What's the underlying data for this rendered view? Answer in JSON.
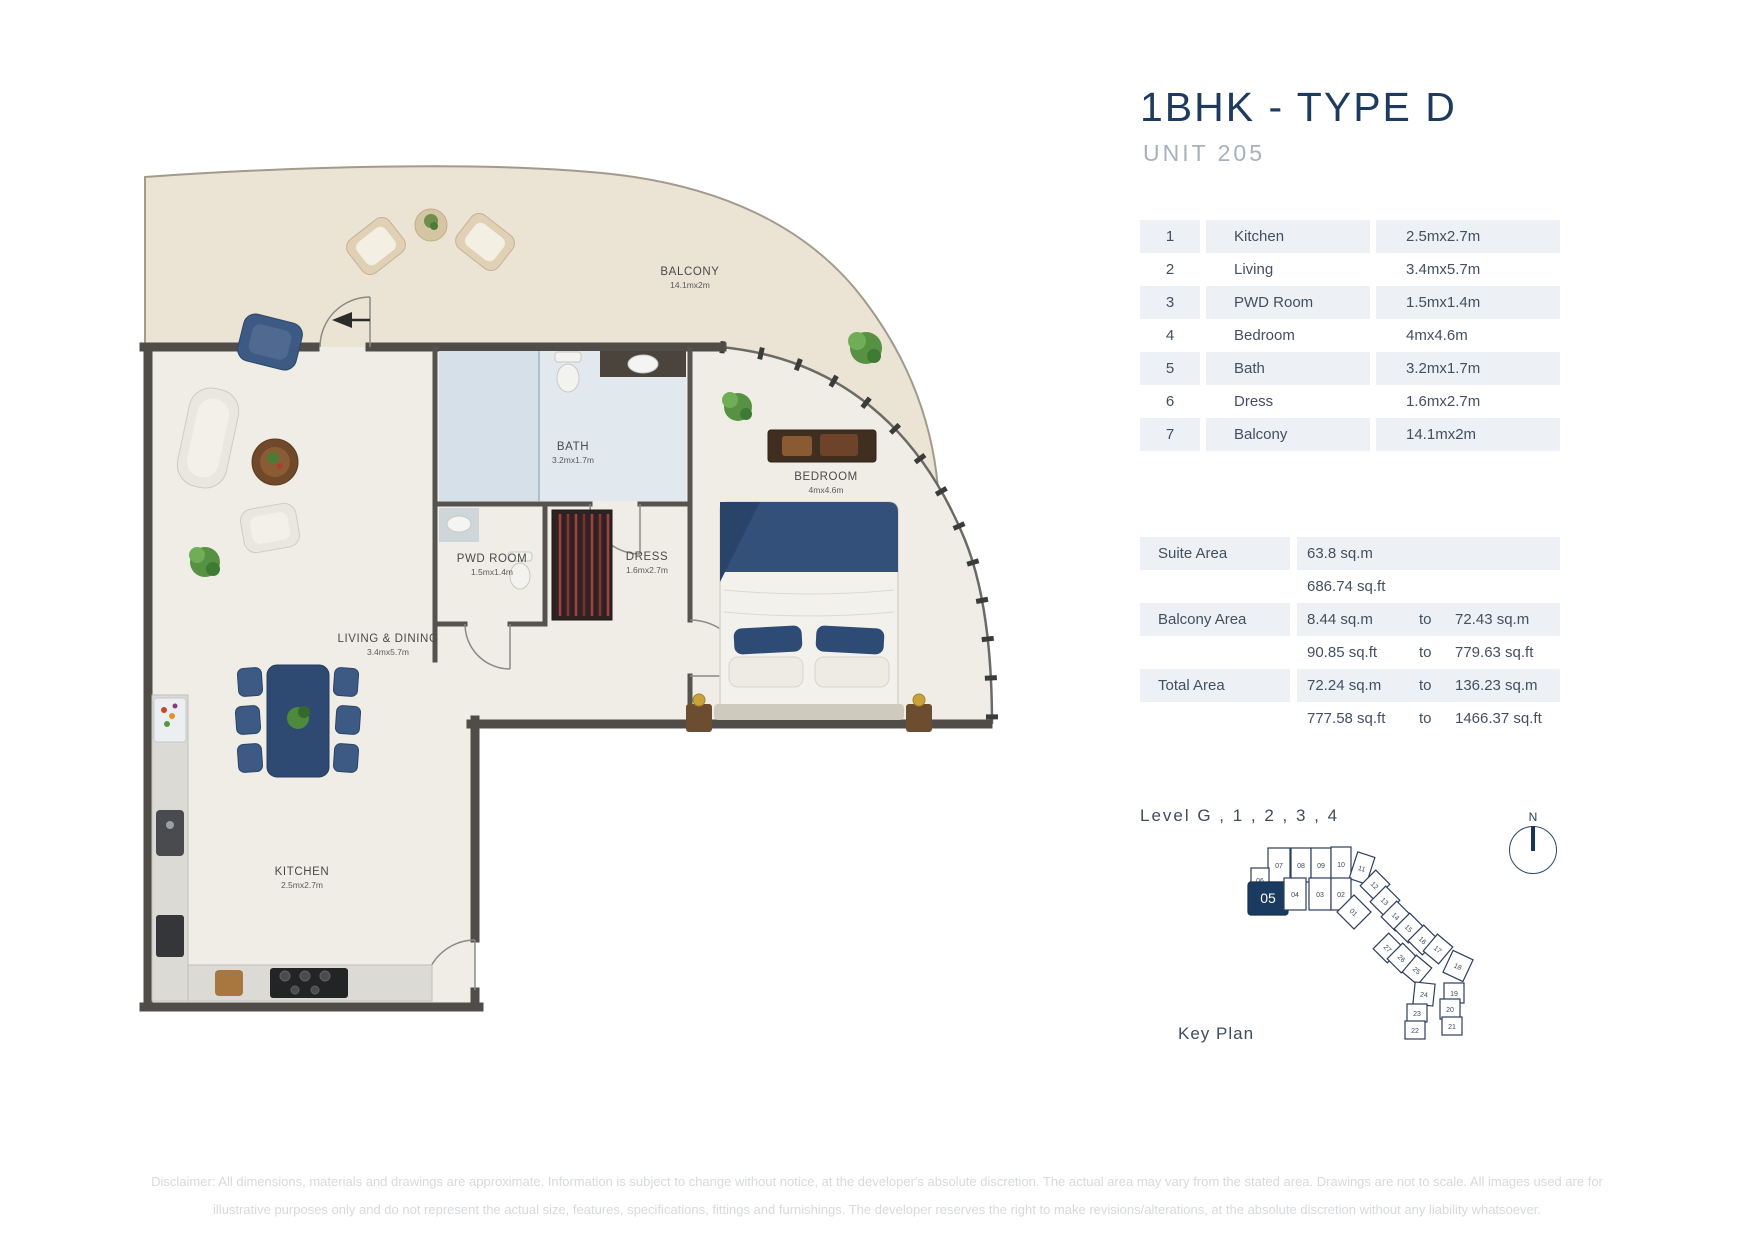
{
  "header": {
    "title": "1BHK - TYPE D",
    "subtitle": "UNIT 205"
  },
  "dimension_table": {
    "rows": [
      {
        "num": "1",
        "name": "Kitchen",
        "size": "2.5mx2.7m"
      },
      {
        "num": "2",
        "name": "Living",
        "size": "3.4mx5.7m"
      },
      {
        "num": "3",
        "name": "PWD Room",
        "size": "1.5mx1.4m"
      },
      {
        "num": "4",
        "name": "Bedroom",
        "size": "4mx4.6m"
      },
      {
        "num": "5",
        "name": "Bath",
        "size": "3.2mx1.7m"
      },
      {
        "num": "6",
        "name": "Dress",
        "size": "1.6mx2.7m"
      },
      {
        "num": "7",
        "name": "Balcony",
        "size": "14.1mx2m"
      }
    ]
  },
  "area_table": {
    "rows": [
      {
        "label": "Suite Area",
        "v1": "63.8 sq.m",
        "to": "",
        "v2": ""
      },
      {
        "label": "",
        "v1": "686.74 sq.ft",
        "to": "",
        "v2": ""
      },
      {
        "label": "Balcony Area",
        "v1": "8.44 sq.m",
        "to": "to",
        "v2": "72.43 sq.m"
      },
      {
        "label": "",
        "v1": "90.85 sq.ft",
        "to": "to",
        "v2": "779.63 sq.ft"
      },
      {
        "label": "Total Area",
        "v1": "72.24 sq.m",
        "to": "to",
        "v2": "136.23 sq.m"
      },
      {
        "label": "",
        "v1": "777.58 sq.ft",
        "to": "to",
        "v2": "1466.37 sq.ft"
      }
    ]
  },
  "level": {
    "label": "Level  G , 1 , 2 , 3 , 4"
  },
  "key_plan": {
    "label": "Key Plan",
    "highlighted_unit": "05",
    "units": [
      "01",
      "02",
      "03",
      "04",
      "05",
      "06",
      "07",
      "08",
      "09",
      "10",
      "11",
      "12",
      "13",
      "14",
      "15",
      "16",
      "17",
      "18",
      "19",
      "20",
      "21",
      "22",
      "23",
      "24",
      "25",
      "26",
      "27"
    ]
  },
  "compass": {
    "north_label": "N"
  },
  "floorplan": {
    "rooms": [
      {
        "name": "BALCONY",
        "dims": "14.1mx2m"
      },
      {
        "name": "BATH",
        "dims": "3.2mx1.7m"
      },
      {
        "name": "BEDROOM",
        "dims": "4mx4.6m"
      },
      {
        "name": "PWD ROOM",
        "dims": "1.5mx1.4m"
      },
      {
        "name": "DRESS",
        "dims": "1.6mx2.7m"
      },
      {
        "name": "LIVING & DINING",
        "dims": "3.4mx5.7m"
      },
      {
        "name": "KITCHEN",
        "dims": "2.5mx2.7m"
      }
    ]
  },
  "disclaimer": {
    "line1": "Disclaimer: All dimensions, materials and drawings are approximate. Information is subject to change without notice, at the developer's absolute discretion. The actual area may vary from the stated area. Drawings are not to scale. All images used are for",
    "line2": "illustrative purposes only and do not represent the actual size, features, specifications, fittings and furnishings. The developer reserves the right to make revisions/alterations, at the absolute discretion without any liability whatsoever."
  },
  "colors": {
    "accent_navy": "#1d3a5f",
    "subtitle_gray": "#a7b1bb",
    "table_stripe": "#edf0f4",
    "wall": "#504d48",
    "floor": "#efede6",
    "balcony_floor": "#ebe3d4"
  }
}
